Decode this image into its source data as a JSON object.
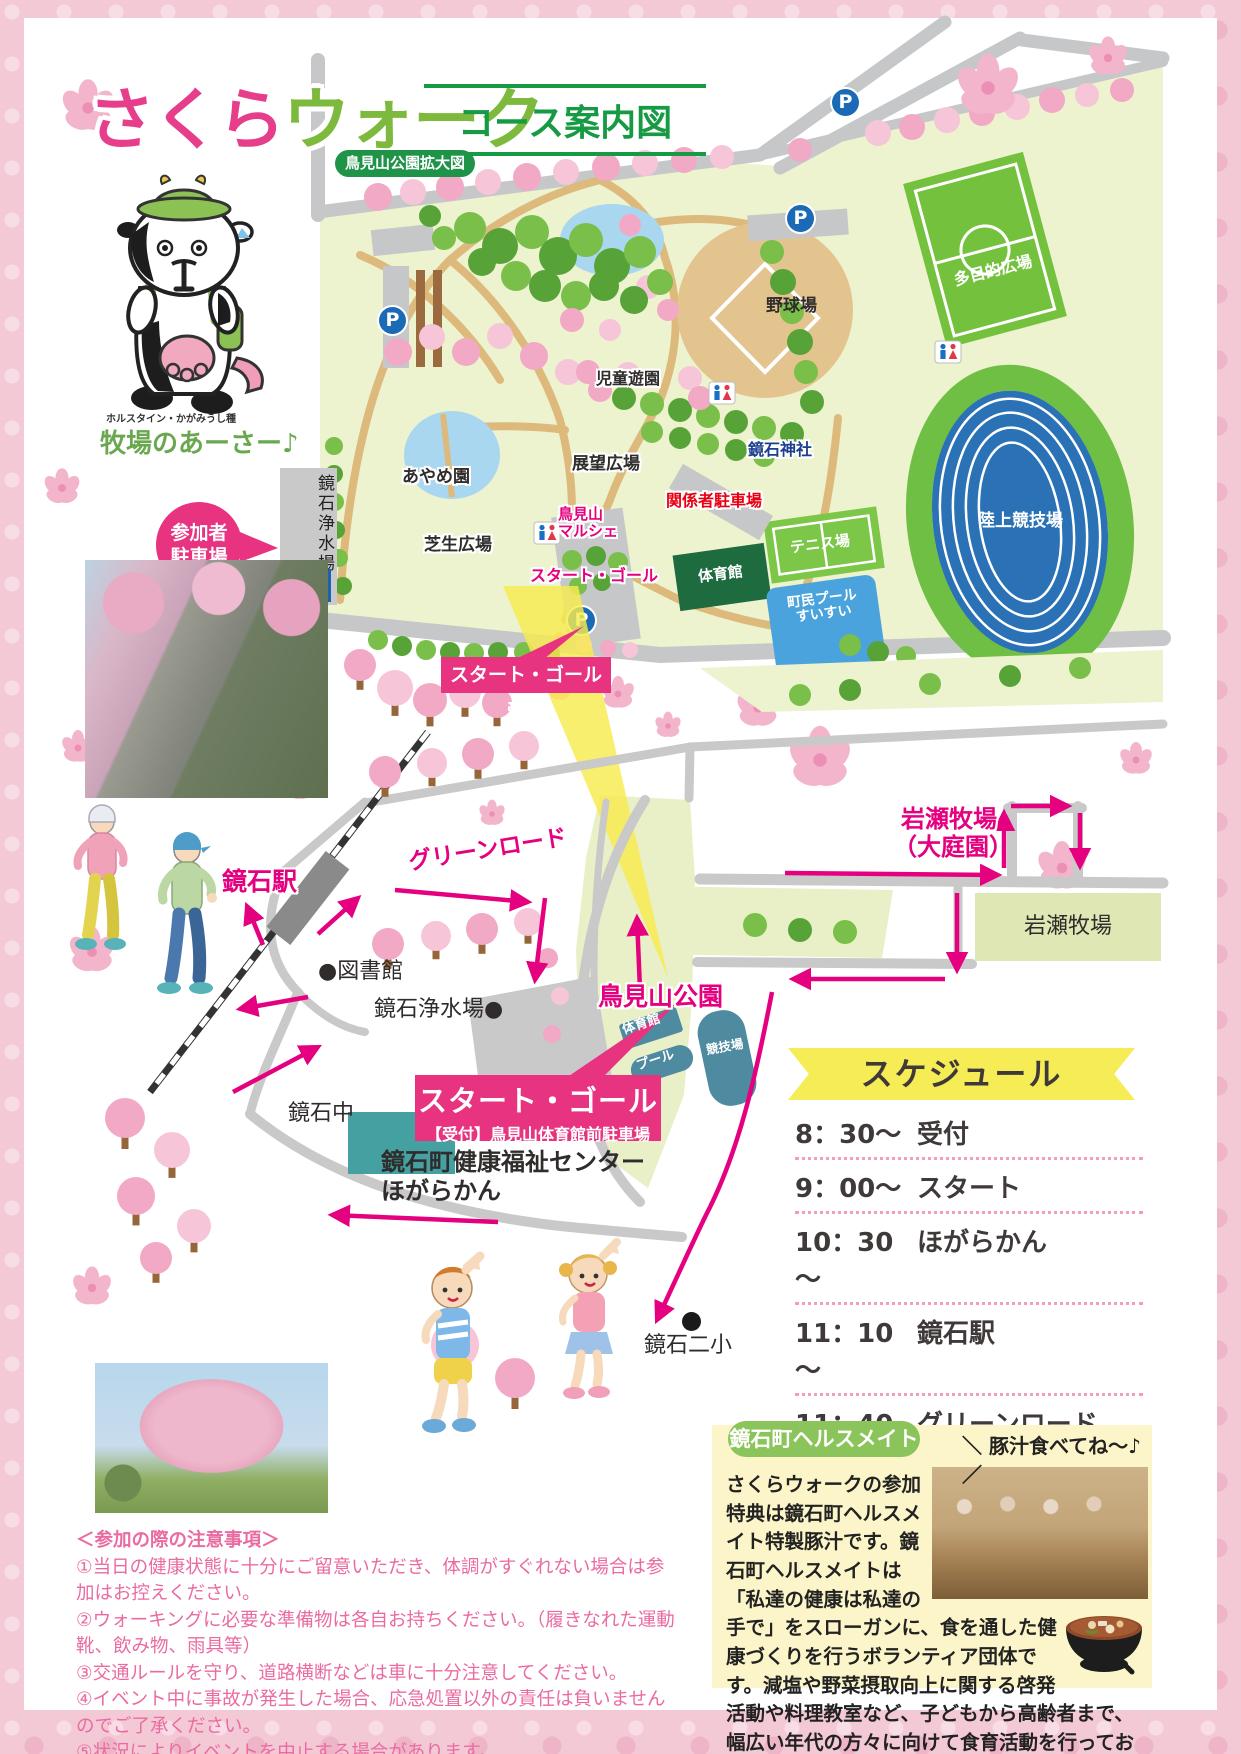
{
  "page": {
    "accent_pink": "#e4007f",
    "accent_green": "#1f9347",
    "box_pink": "#e73380"
  },
  "title": {
    "main_sakura": "さくら",
    "main_walk": "ウォーク",
    "course_label": "コース案内図",
    "park_zoom_badge": "鳥見山公園拡大図"
  },
  "mascot": {
    "breed_caption": "ホルスタイン・かがみうし種",
    "name_caption": "牧場のあーさー♪"
  },
  "parking": {
    "bubble_line1": "参加者",
    "bubble_line2": "駐車場",
    "water_plant_vertical": "鏡石浄水場",
    "p_letter": "P"
  },
  "park_map": {
    "labels": {
      "jido_yuen": "児童遊園",
      "yakyujo": "野球場",
      "tamokuteki": "多目的広場",
      "jinja": "鏡石神社",
      "ayame": "あやめ園",
      "tenbo": "展望広場",
      "kankeisha": "関係者駐車場",
      "marche_1": "鳥見山",
      "marche_2": "マルシェ",
      "start_goal": "スタート・ゴール",
      "shibafu": "芝生広場",
      "tennis": "テニス場",
      "taiikukan": "体育館",
      "pool_1": "町民プール",
      "pool_2": "すいすい",
      "rikujo": "陸上競技場",
      "uketsuke": "スタート・ゴール受付"
    }
  },
  "lower_map": {
    "labels": {
      "green_road": "グリーンロード",
      "station": "鏡石駅",
      "library": "●図書館",
      "water_plant": "鏡石浄水場●",
      "toriyama_park": "鳥見山公園",
      "gym": "体育館",
      "pool": "プール",
      "track": "競技場",
      "start_goal_line1": "スタート・ゴール",
      "start_goal_line2": "【受付】鳥見山体育館前駐車場",
      "junior_high": "鏡石中",
      "center_line1": "鏡石町健康福祉センター",
      "center_line2": "ほがらかん",
      "elementary": "鏡石二小",
      "iwase_line1": "岩瀬牧場",
      "iwase_line2": "（大庭園）",
      "iwase_box": "岩瀬牧場"
    }
  },
  "schedule": {
    "title": "スケジュール",
    "items": [
      {
        "time": "8：30～",
        "label": "受付"
      },
      {
        "time": "9：00～",
        "label": "スタート"
      },
      {
        "time": "10：30～",
        "label": "ほがらかん"
      },
      {
        "time": "11：10～",
        "label": "鏡石駅"
      },
      {
        "time": "11：40～",
        "label": "グリーンロード"
      },
      {
        "time": "12：00",
        "label": "さくらウォーク終了"
      }
    ]
  },
  "notes": {
    "title": "＜参加の際の注意事項＞",
    "items": [
      "①当日の健康状態に十分にご留意いただき、体調がすぐれない場合は参加はお控えください。",
      "②ウォーキングに必要な準備物は各自お持ちください。（履きなれた運動靴、飲み物、雨具等）",
      "③交通ルールを守り、道路横断などは車に十分注意してください。",
      "④イベント中に事故が発生した場合、応急処置以外の責任は負いませんのでご了承ください。",
      "⑤状況によりイベントを中止する場合があります。",
      "⑥事業の写真はチラシ・SNS等に使用する場合がございますのでご了承ください。"
    ]
  },
  "healthmate": {
    "badge": "鏡石町ヘルスメイト",
    "callout": "＼ 豚汁食べてね～♪／",
    "body": "さくらウォークの参加特典は鏡石町ヘルスメイト特製豚汁です。鏡石町ヘルスメイトは「私達の健康は私達の手で」をスローガンに、食を通した健康づくりを行うボランティア団体です。減塩や野菜摂取向上に関する啓発活動や料理教室など、子どもから高齢者まで、幅広い年代の方々に向けて食育活動を行っております。"
  }
}
